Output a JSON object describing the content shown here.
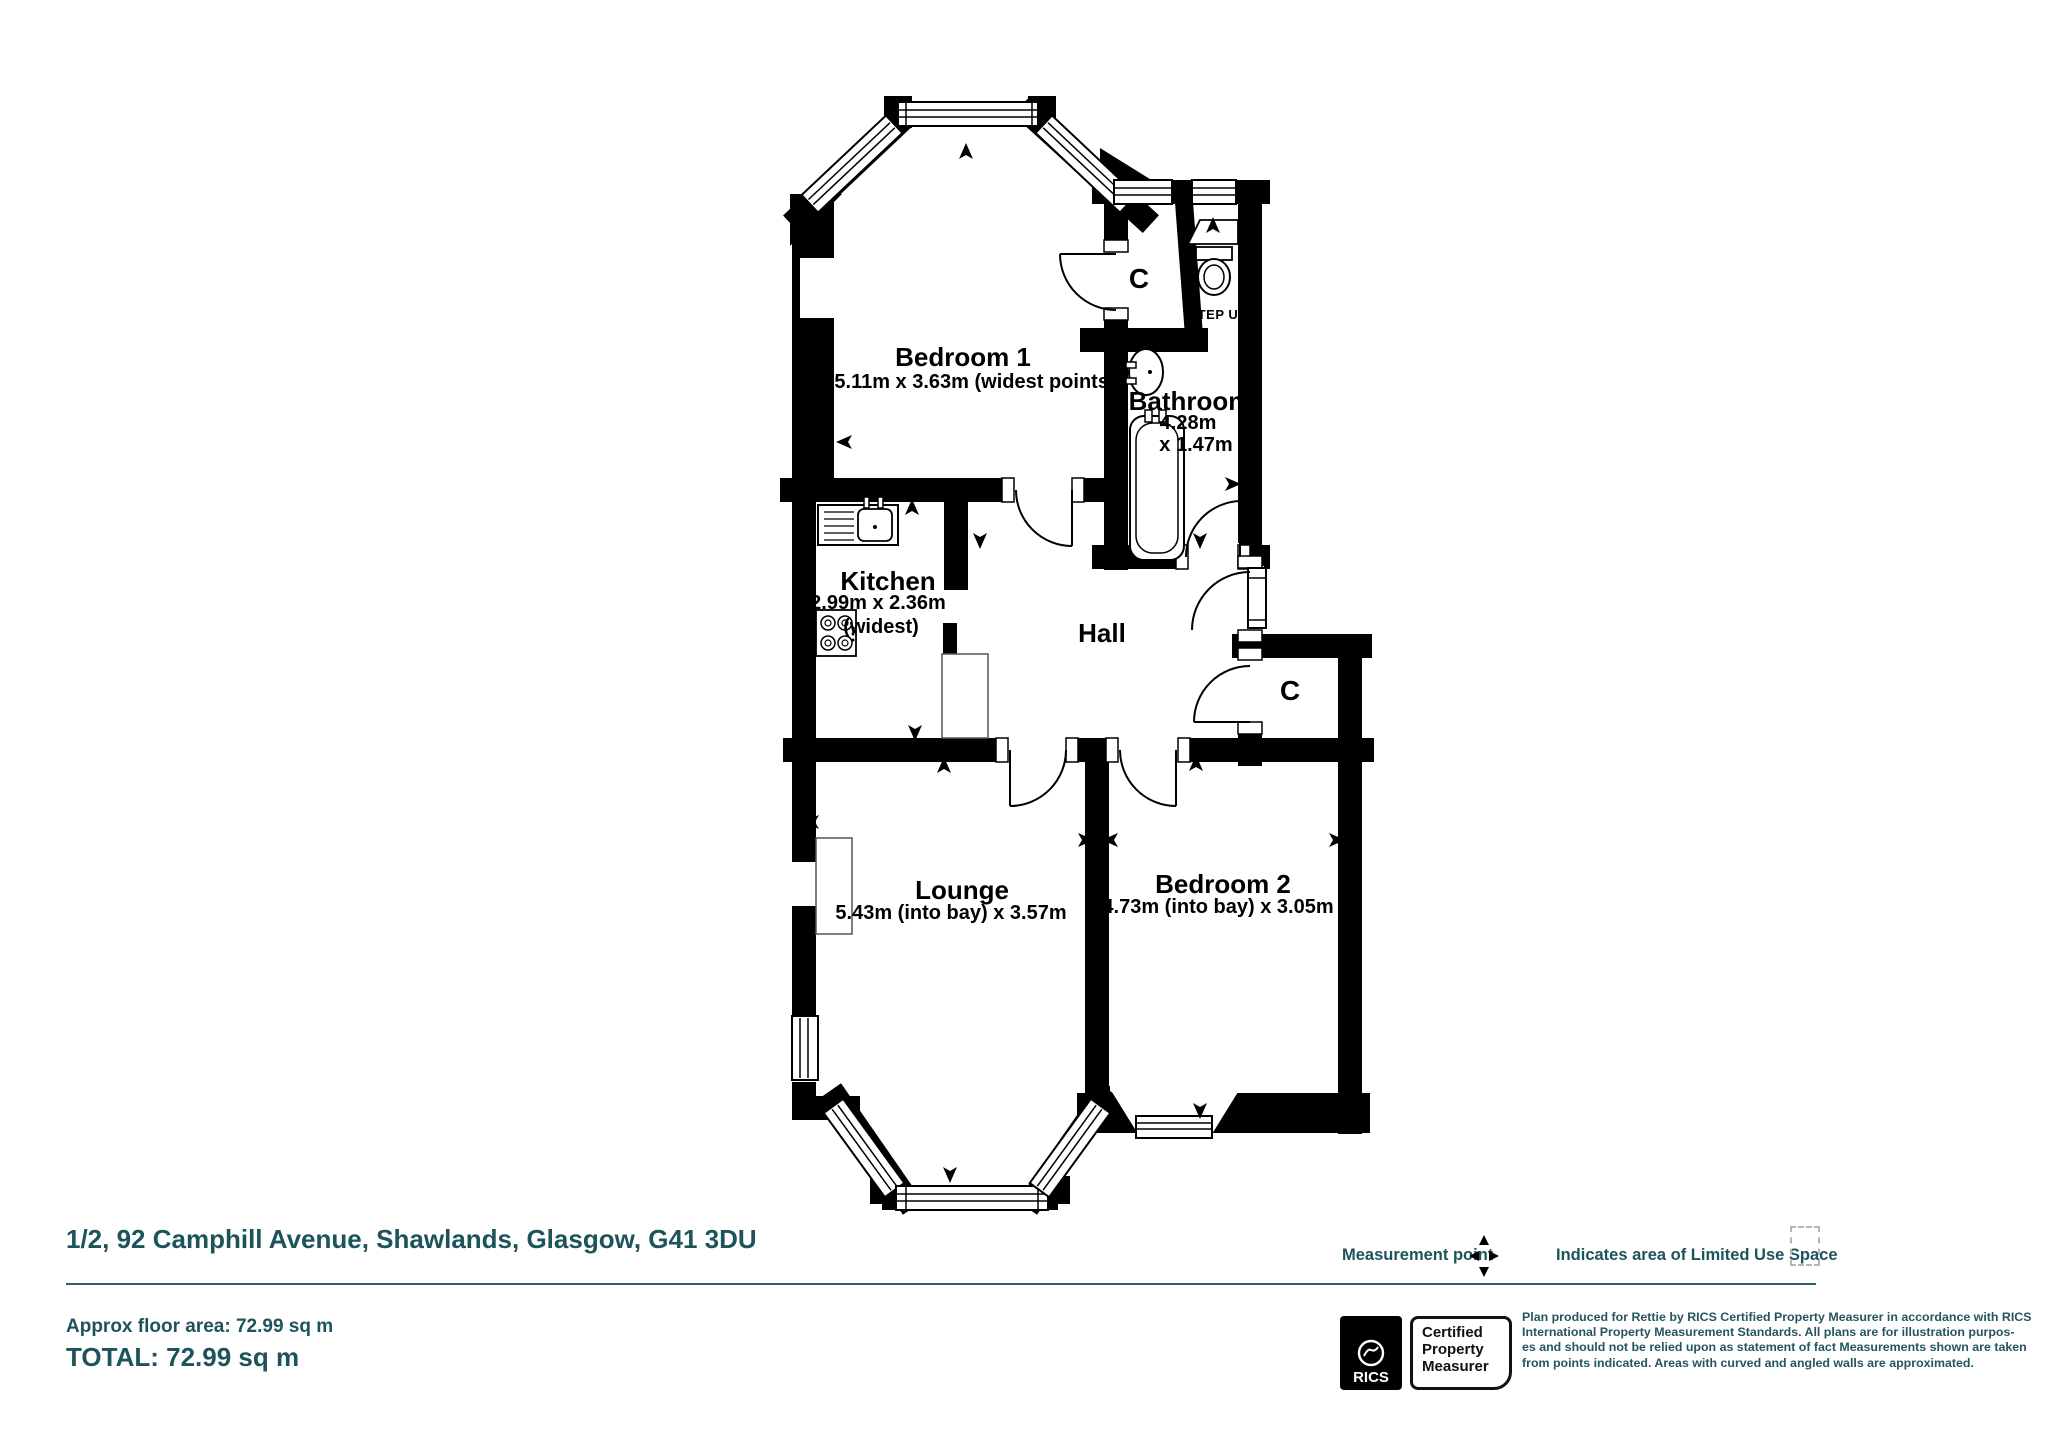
{
  "colors": {
    "wall": "#000000",
    "teal": "#1d535b",
    "dash_gray": "#b5b5b5"
  },
  "plan": {
    "rooms": {
      "bedroom1": {
        "label": "Bedroom 1",
        "dims": "5.11m x 3.63m (widest points)"
      },
      "bathroom": {
        "label": "Bathroom",
        "dims1": "4.28m",
        "dims2": "x 1.47m"
      },
      "kitchen": {
        "label": "Kitchen",
        "dims": "2.99m x 2.36m",
        "note": "(widest)"
      },
      "hall": {
        "label": "Hall"
      },
      "lounge": {
        "label": "Lounge",
        "dims": "5.43m (into bay) x 3.57m"
      },
      "bedroom2": {
        "label": "Bedroom 2",
        "dims": "4.73m (into bay) x 3.05m"
      }
    },
    "annotations": {
      "cupboard_top": "C",
      "cupboard_hall": "C",
      "step_up": "STEP UP"
    }
  },
  "footer": {
    "address": "1/2, 92 Camphill Avenue, Shawlands, Glasgow, G41 3DU",
    "approx_area": "Approx floor area: 72.99 sq m",
    "total": "TOTAL: 72.99 sq m"
  },
  "legend": {
    "measurement_point": "Measurement point",
    "limited_use": "Indicates area of  Limited Use Space"
  },
  "certification": {
    "brand": "RICS",
    "badge_lines": [
      "Certified",
      "Property",
      "Measurer"
    ]
  },
  "disclaimer": {
    "lines": [
      "Plan produced for Rettie by RICS Certified Property Measurer in accordance with RICS",
      "International Property  Measurement Standards.  All plans are for illustration purpos-",
      "es and should not be relied upon as statement of fact Measurements shown are taken",
      "from points indicated. Areas with curved and angled walls are approximated."
    ]
  }
}
